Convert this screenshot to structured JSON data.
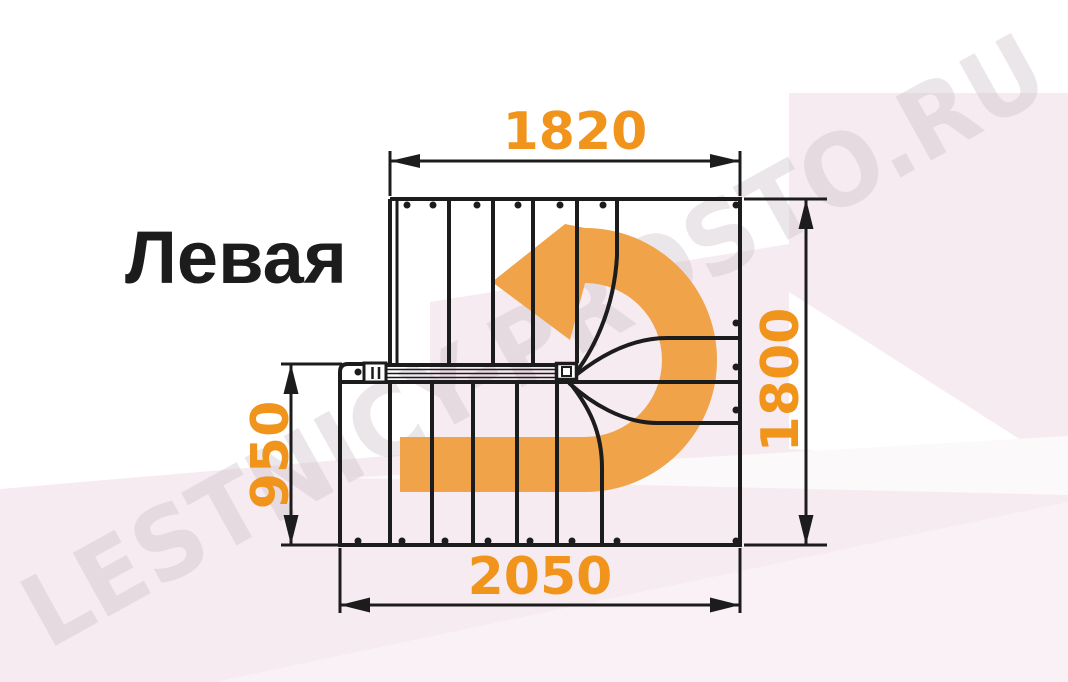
{
  "title": "Левая",
  "watermark": "LESTNICY-PROSTO.RU",
  "dimensions": {
    "top": "1820",
    "right": "1800",
    "left": "950",
    "bottom": "2050"
  },
  "colors": {
    "line": "#1c1c1c",
    "dimension_text": "#F0941C",
    "arrow_fill": "#F0A348",
    "watermark": "#CFC5CB",
    "background_tint": "#F7EBF2",
    "background_tint_light": "#FAF1F6",
    "background_wedge": "#FCF9FB"
  }
}
